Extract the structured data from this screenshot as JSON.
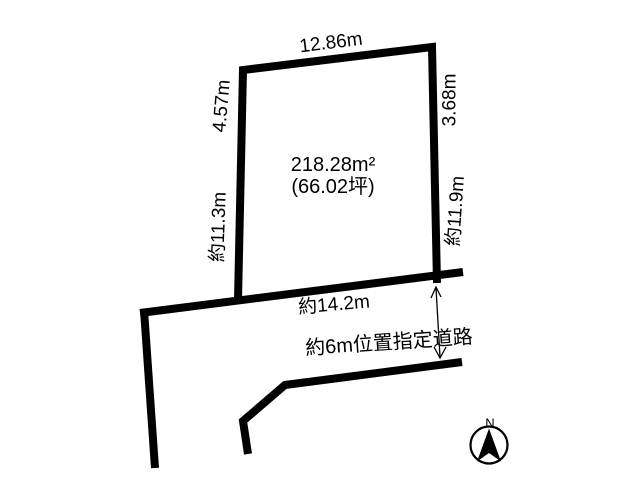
{
  "plot": {
    "area_label_line1": "218.28m²",
    "area_label_line2": "(66.02坪)",
    "dimensions": {
      "top": "12.86m",
      "left_upper": "4.57m",
      "left_lower": "約11.3m",
      "right_upper": "3.68m",
      "right_lower": "約11.9m",
      "frontage": "約14.2m"
    }
  },
  "road": {
    "label": "約6m位置指定道路"
  },
  "compass": {
    "north_label": "N"
  },
  "colors": {
    "line": "#000000",
    "background": "#ffffff"
  }
}
